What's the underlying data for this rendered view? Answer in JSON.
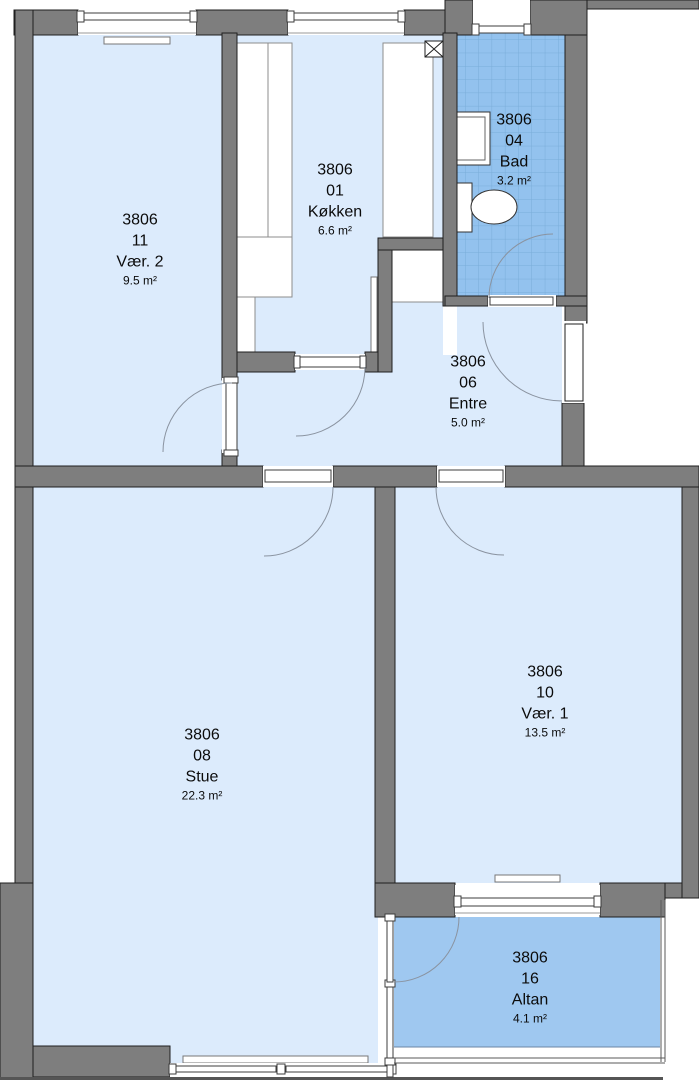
{
  "title": "Apartment floor plan 3806",
  "rooms": [
    {
      "building": "3806",
      "number": "11",
      "name": "Vær. 2",
      "area": "9.5 m²"
    },
    {
      "building": "3806",
      "number": "01",
      "name": "Køkken",
      "area": "6.6 m²"
    },
    {
      "building": "3806",
      "number": "04",
      "name": "Bad",
      "area": "3.2 m²"
    },
    {
      "building": "3806",
      "number": "06",
      "name": "Entre",
      "area": "5.0 m²"
    },
    {
      "building": "3806",
      "number": "08",
      "name": "Stue",
      "area": "22.3 m²"
    },
    {
      "building": "3806",
      "number": "10",
      "name": "Vær. 1",
      "area": "13.5 m²"
    },
    {
      "building": "3806",
      "number": "16",
      "name": "Altan",
      "area": "4.1 m²"
    }
  ],
  "icons": {
    "toilet": "toilet-plan-symbol",
    "sink": "washbasin-plan-symbol",
    "vent": "ventilation-shaft-x-symbol",
    "radiator": "radiator-strip-symbol"
  },
  "colors": {
    "room_fill": "#dcebfc",
    "tile_fill": "#93c2ee",
    "tile_line": "#7aadd9",
    "balcony_fill": "#9fc8f0",
    "wall_fill": "#7e7e7e",
    "wall_stroke": "#1f1f1f",
    "arc_stroke": "#8a93a0"
  }
}
